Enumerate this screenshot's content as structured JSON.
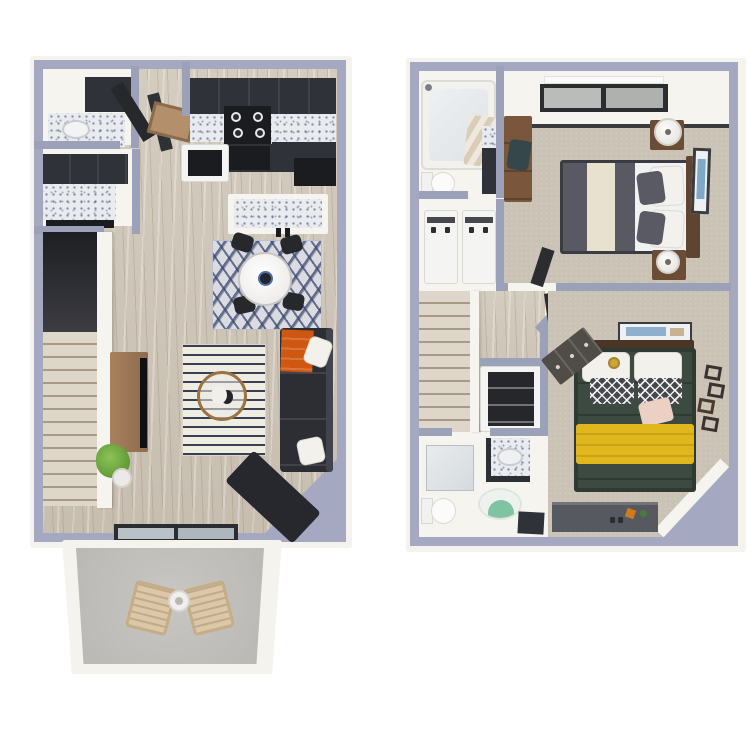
{
  "image_type": "3d-rendered two-level apartment floor plan, top-down view, no text labels",
  "colors": {
    "wall": "#9ba1b9",
    "wallOuter": "#a4a8c1",
    "wallface": "#f6f4ef",
    "outerband": "#f5f3ee",
    "wood": "#cfc7b9",
    "carpet": "#c9c2b5",
    "cabinet": "#2f3238",
    "patio_concrete": "#bab8b4",
    "sofa": "#2c2e34",
    "throw_orange": "#cf5711",
    "duvet_green": "#3c4a41",
    "throw_yellow": "#e0b81e",
    "duvet_gray": "#585963",
    "duvet_cream": "#e8e1ce",
    "rug_navy": "#2f374f",
    "bath_rug_green": "#7fc3a2",
    "wood_furniture": "#8d6b4e",
    "headboard_brown": "#5e4431",
    "plant_green": "#6faf45",
    "wicker_tan": "#dcc8a8"
  },
  "floors": [
    {
      "name": "first-floor",
      "rooms": [
        {
          "name": "powder-room",
          "furniture": [
            "granite-vanity",
            "sink",
            "dark-cabinet"
          ]
        },
        {
          "name": "built-in-cabinet-nook",
          "furniture": [
            "dark-cabinets",
            "granite-counter"
          ]
        },
        {
          "name": "entry",
          "furniture": [
            "open-door-leaves",
            "doormat"
          ]
        },
        {
          "name": "kitchen",
          "furniture": [
            "upper-cabinets",
            "granite-countertop",
            "stove-with-4-burners",
            "oven",
            "side-cabinets",
            "pantry-closet",
            "island-with-granite-top"
          ]
        },
        {
          "name": "dining-area",
          "furniture": [
            "chevron-rug",
            "round-marble-table",
            "centerpiece-bowl",
            "four-dark-chairs"
          ]
        },
        {
          "name": "living-room",
          "furniture": [
            "striped-rug",
            "round-coffee-table",
            "tv-console",
            "tv",
            "dark-sectional-sofa",
            "chaise",
            "orange-throw-blanket",
            "two-white-pillows",
            "potted-plant"
          ]
        },
        {
          "name": "staircase",
          "furniture": [
            "wood-steps",
            "stairwell-void",
            "railing-wall"
          ]
        },
        {
          "name": "patio",
          "furniture": [
            "sliding-glass-door",
            "concrete-floor",
            "two-wicker-lounge-chairs",
            "round-side-table"
          ]
        }
      ]
    },
    {
      "name": "second-floor",
      "rooms": [
        {
          "name": "bathroom-1",
          "furniture": [
            "bathtub",
            "faucet",
            "striped-towel",
            "toilet",
            "dark-vanity"
          ]
        },
        {
          "name": "laundry-closet",
          "furniture": [
            "washer",
            "dryer"
          ]
        },
        {
          "name": "bedroom-1",
          "furniture": [
            "double-window",
            "desk",
            "desk-chair",
            "striped-duvet-bed",
            "wood-headboard",
            "two-white-pillows",
            "two-gray-pillows",
            "nightstand-with-lamp-top",
            "nightstand-with-lamp-bottom",
            "framed-wall-art"
          ]
        },
        {
          "name": "hallway",
          "furniture": [
            "wood-floor",
            "staircase-down",
            "railing-wall",
            "linen-closet",
            "bedroom-door-leaves"
          ]
        },
        {
          "name": "bathroom-2",
          "furniture": [
            "glass-shower",
            "granite-vanity-with-sink",
            "green-round-rug",
            "toilet",
            "dark-cabinet"
          ]
        },
        {
          "name": "bedroom-2",
          "furniture": [
            "green-duvet-bed",
            "yellow-throw-blanket",
            "white-pillows",
            "trellis-pattern-pillows",
            "blush-pillow",
            "gold-dish",
            "headboard",
            "art-above-headboard",
            "angled-dresser",
            "low-console-with-decor",
            "geometric-wall-decor"
          ]
        }
      ]
    }
  ]
}
